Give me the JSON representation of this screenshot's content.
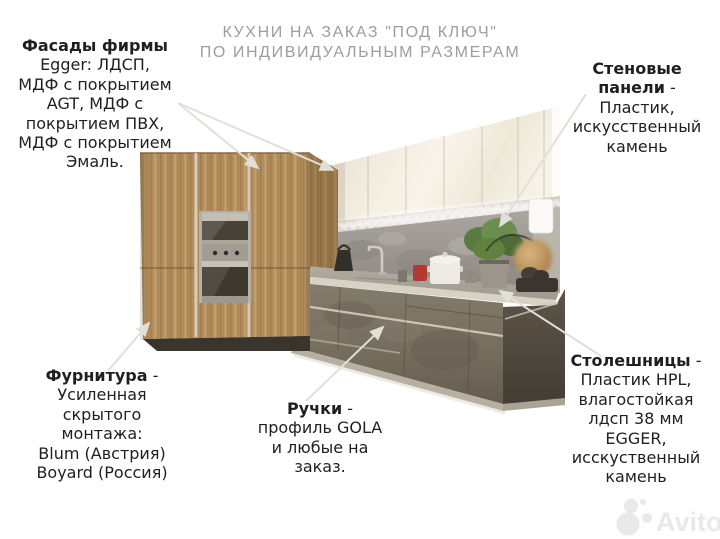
{
  "title": {
    "text": "КУХНИ НА ЗАКАЗ \"ПОД КЛЮЧ\"\nПО ИНДИВИДУАЛЬНЫМ РАЗМЕРАМ"
  },
  "callouts": {
    "facades": {
      "title": "Фасады фирмы",
      "dash": "",
      "body": "Egger: ЛДСП,\nМДФ с покрытием\nAGT, МДФ с\nпокрытием ПВХ,\nМДФ с покрытием\nЭмаль."
    },
    "wall_panels": {
      "title": "Стеновые\nпанели",
      "dash": " -",
      "body": "Пластик,\nискусственный\nкамень"
    },
    "hardware": {
      "title": "Фурнитура",
      "dash": " -",
      "body": "Усиленная\nскрытого\nмонтажа:\nBlum (Австрия)\nBoyard (Россия)"
    },
    "handles": {
      "title": "Ручки",
      "dash": " -",
      "body": "профиль GOLA\nи любые на\nзаказ."
    },
    "countertops": {
      "title": "Столешницы",
      "dash": " -",
      "body": "Пластик HPL,\nвлагостойкая\nлдсп 38 мм\nEGGER,\nисскуственный\nкамень"
    }
  },
  "watermark": {
    "text": "Avito"
  },
  "colors": {
    "background": "#ffffff",
    "titleGray": "#9d9d9d",
    "textDark": "#1f1f1f",
    "leader": "#e7e4dc",
    "wood": "#b28c5c",
    "woodDark": "#97744a",
    "cream": "#f1ebdd",
    "backsplash": "#9a958f",
    "counter": "#b3ada1",
    "baseConcrete": "#77705f",
    "endPanel": "#554d42",
    "steel": "#b5b1a6",
    "plantGreen": "#61823f",
    "lampGold": "#c09a64",
    "watermark": "#e9e9e9"
  }
}
